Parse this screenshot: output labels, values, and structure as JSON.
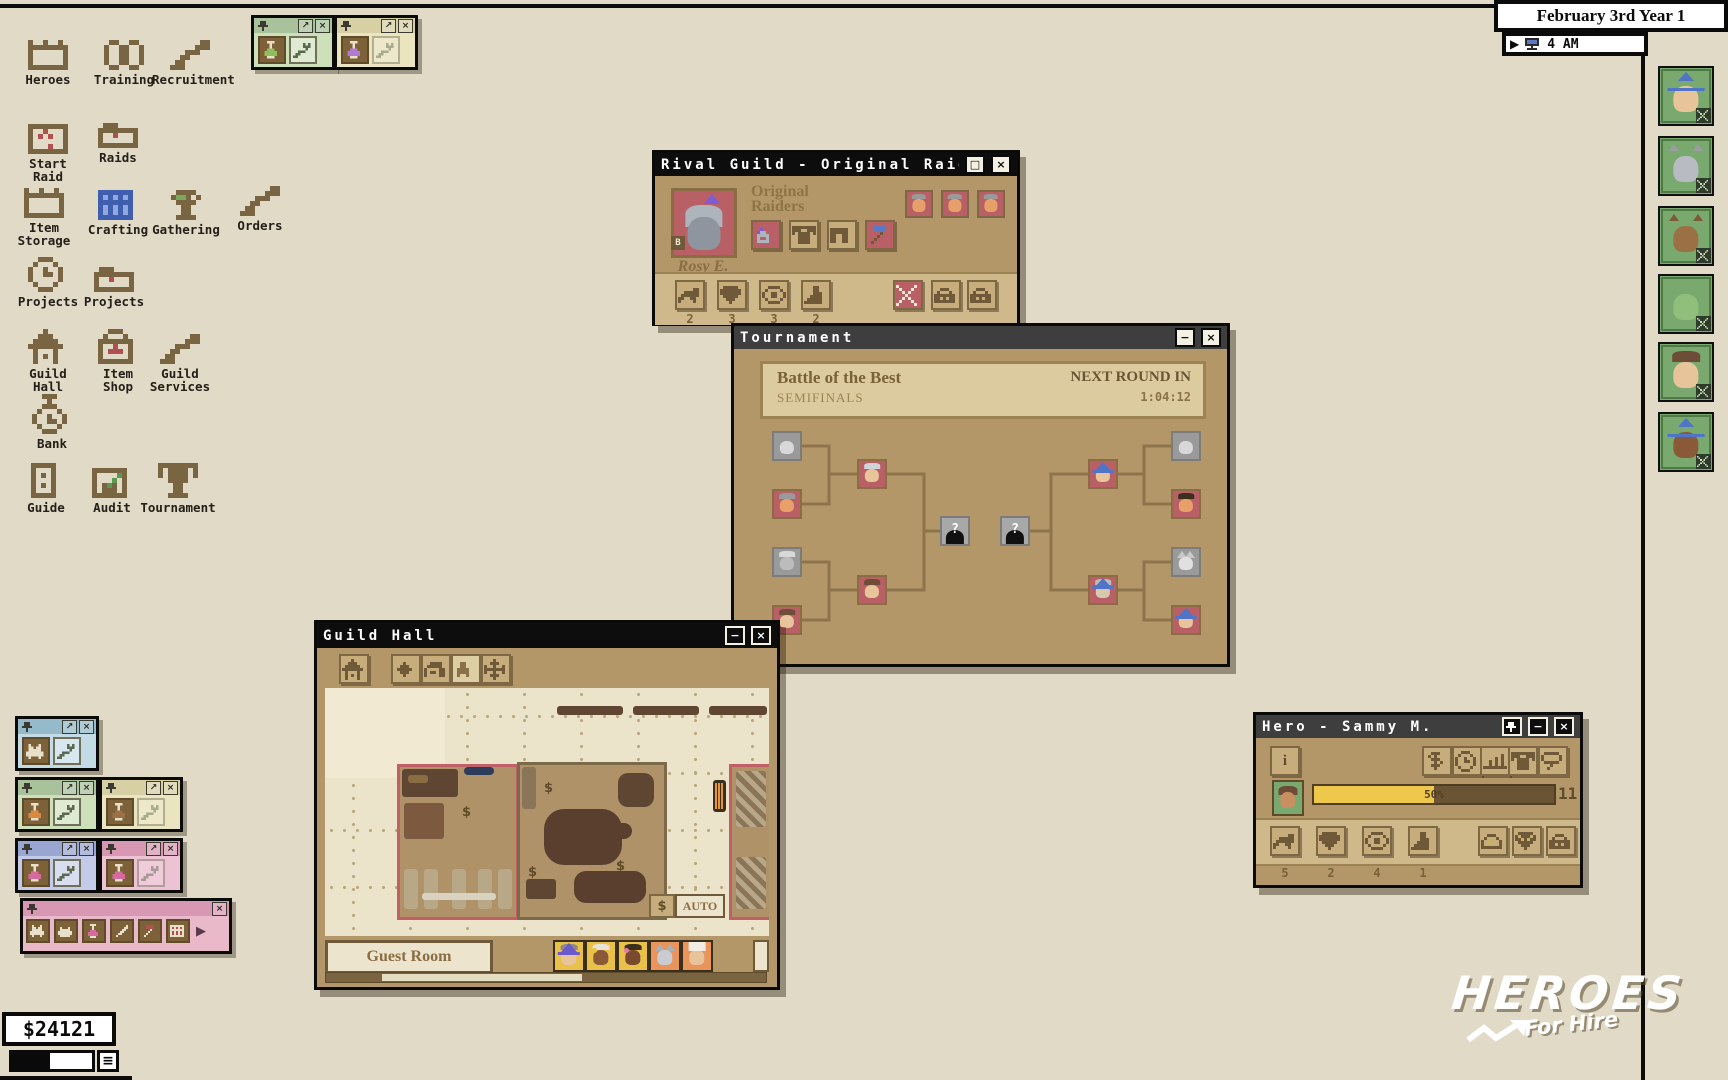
{
  "topbar": {
    "date": "February 3rd Year 1",
    "time": "4 AM",
    "play_icon": "play",
    "monitor_icon": "monitor"
  },
  "desktop": {
    "icons": [
      {
        "label": "Heroes",
        "icon": "bin"
      },
      {
        "label": "Training",
        "icon": "book"
      },
      {
        "label": "Recruitment",
        "icon": "arm"
      },
      {
        "label": "Start\nRaid",
        "icon": "map"
      },
      {
        "label": "Raids",
        "icon": "folder"
      },
      {
        "label": "Item\nStorage",
        "icon": "bin"
      },
      {
        "label": "Crafting",
        "icon": "grid"
      },
      {
        "label": "Gathering",
        "icon": "stump"
      },
      {
        "label": "Orders",
        "icon": "arm"
      },
      {
        "label": "Projects",
        "icon": "stopwatch"
      },
      {
        "label": "Projects",
        "icon": "folder"
      },
      {
        "label": "Guild\nHall",
        "icon": "house"
      },
      {
        "label": "Item\nShop",
        "icon": "shopbag"
      },
      {
        "label": "Guild\nServices",
        "icon": "arm"
      },
      {
        "label": "Bank",
        "icon": "moneybag"
      },
      {
        "label": "Guide",
        "icon": "paper"
      },
      {
        "label": "Audit",
        "icon": "chart"
      },
      {
        "label": "Tournament",
        "icon": "trophy"
      }
    ]
  },
  "windows": {
    "rival_guild": {
      "title": "Rival Guild - Original Raider",
      "guild_name": "Original\nRaiders",
      "leader_name": "Rosy E.",
      "leader_badge": "B",
      "equipment_icons": [
        "helmet",
        "shirt",
        "pants",
        "hammer"
      ],
      "member_portraits": 3,
      "stats": [
        {
          "icon": "fist",
          "value": "2"
        },
        {
          "icon": "shield",
          "value": "3"
        },
        {
          "icon": "eye",
          "value": "3"
        },
        {
          "icon": "boot",
          "value": "2"
        }
      ],
      "action_icons": [
        "tools",
        "lock",
        "lock"
      ]
    },
    "tournament": {
      "title": "Tournament",
      "event_title": "Battle of the Best",
      "stage": "SEMIFINALS",
      "next_round_label": "NEXT ROUND IN",
      "next_round_timer": "1:04:12",
      "bracket": {
        "round1_left": [
          {
            "state": "eliminated",
            "char": "ghost"
          },
          {
            "state": "advanced",
            "char": "gray-hair"
          },
          {
            "state": "eliminated",
            "char": "pale-hood"
          },
          {
            "state": "advanced",
            "char": "brown-hood"
          }
        ],
        "semifinal_left": [
          {
            "state": "advanced",
            "char": "viking"
          },
          {
            "state": "advanced",
            "char": "brown-hood"
          }
        ],
        "finals": [
          {
            "state": "unknown",
            "char": "question"
          },
          {
            "state": "unknown",
            "char": "question"
          }
        ],
        "semifinal_right": [
          {
            "state": "advanced",
            "char": "blue-wizard"
          },
          {
            "state": "advanced",
            "char": "old-wizard"
          }
        ],
        "round1_right": [
          {
            "state": "eliminated",
            "char": "ghost"
          },
          {
            "state": "advanced",
            "char": "dark-hair"
          },
          {
            "state": "eliminated",
            "char": "cat"
          },
          {
            "state": "advanced",
            "char": "blue-wizard"
          }
        ],
        "question_mark": "?"
      }
    },
    "guild_hall": {
      "title": "Guild Hall",
      "toolbar_icons": [
        "house",
        "diamond",
        "building",
        "person",
        "move"
      ],
      "auto_label": "AUTO",
      "room_tab": "Guest Room",
      "guest_avatars": 5
    },
    "hero": {
      "title": "Hero - Sammy M.",
      "info_icon": "info",
      "top_icons": [
        "dollar",
        "stopwatch",
        "bars",
        "shirt",
        "bubble"
      ],
      "progress_percent": "50%",
      "level": "11",
      "stats": [
        {
          "icon": "fist",
          "value": "5"
        },
        {
          "icon": "shield",
          "value": "2"
        },
        {
          "icon": "eye",
          "value": "4"
        },
        {
          "icon": "boot",
          "value": "1"
        }
      ],
      "action_icons": [
        "gauge",
        "shieldswap",
        "lock"
      ]
    }
  },
  "mini_windows": {
    "top": [
      {
        "theme": "green",
        "items": [
          {
            "icon": "flask",
            "accent": "#8fbf5a"
          },
          {
            "icon": "wrench"
          }
        ]
      },
      {
        "theme": "cream",
        "items": [
          {
            "icon": "flask",
            "accent": "#b07ad0"
          },
          {
            "icon": "wrench",
            "faded": true
          }
        ]
      }
    ],
    "bottom": [
      {
        "theme": "blue",
        "items": [
          {
            "icon": "cat",
            "accent": "#c9cdd2"
          },
          {
            "icon": "wrench"
          }
        ]
      },
      {
        "theme": "green2",
        "items": [
          {
            "icon": "flask",
            "accent": "#d98a3f"
          },
          {
            "icon": "wrench"
          }
        ]
      },
      {
        "theme": "cream2",
        "items": [
          {
            "icon": "flask",
            "accent": "#9a7044"
          },
          {
            "icon": "wrench",
            "faded": true
          }
        ]
      },
      {
        "theme": "lavender",
        "items": [
          {
            "icon": "flask",
            "accent": "#d66a9d"
          },
          {
            "icon": "wrench"
          }
        ]
      },
      {
        "theme": "pink",
        "items": [
          {
            "icon": "flask",
            "accent": "#d66a9d"
          },
          {
            "icon": "wrench",
            "faded": true
          }
        ]
      }
    ],
    "pink_toolbar": {
      "items": [
        "cat",
        "bear",
        "flask",
        "pencil",
        "hammer",
        "grid"
      ],
      "play_icon": "▶"
    }
  },
  "hud": {
    "money": "$24121",
    "menu_icon": "≡"
  },
  "sidebar_heroes": [
    {
      "char": "blue-wizard"
    },
    {
      "char": "gray-wolf"
    },
    {
      "char": "brown-bear"
    },
    {
      "char": "green-slime"
    },
    {
      "char": "brown-hair-girl"
    },
    {
      "char": "dark-wizard"
    }
  ],
  "logo": {
    "line1": "HEROES",
    "line2": "For Hire"
  }
}
